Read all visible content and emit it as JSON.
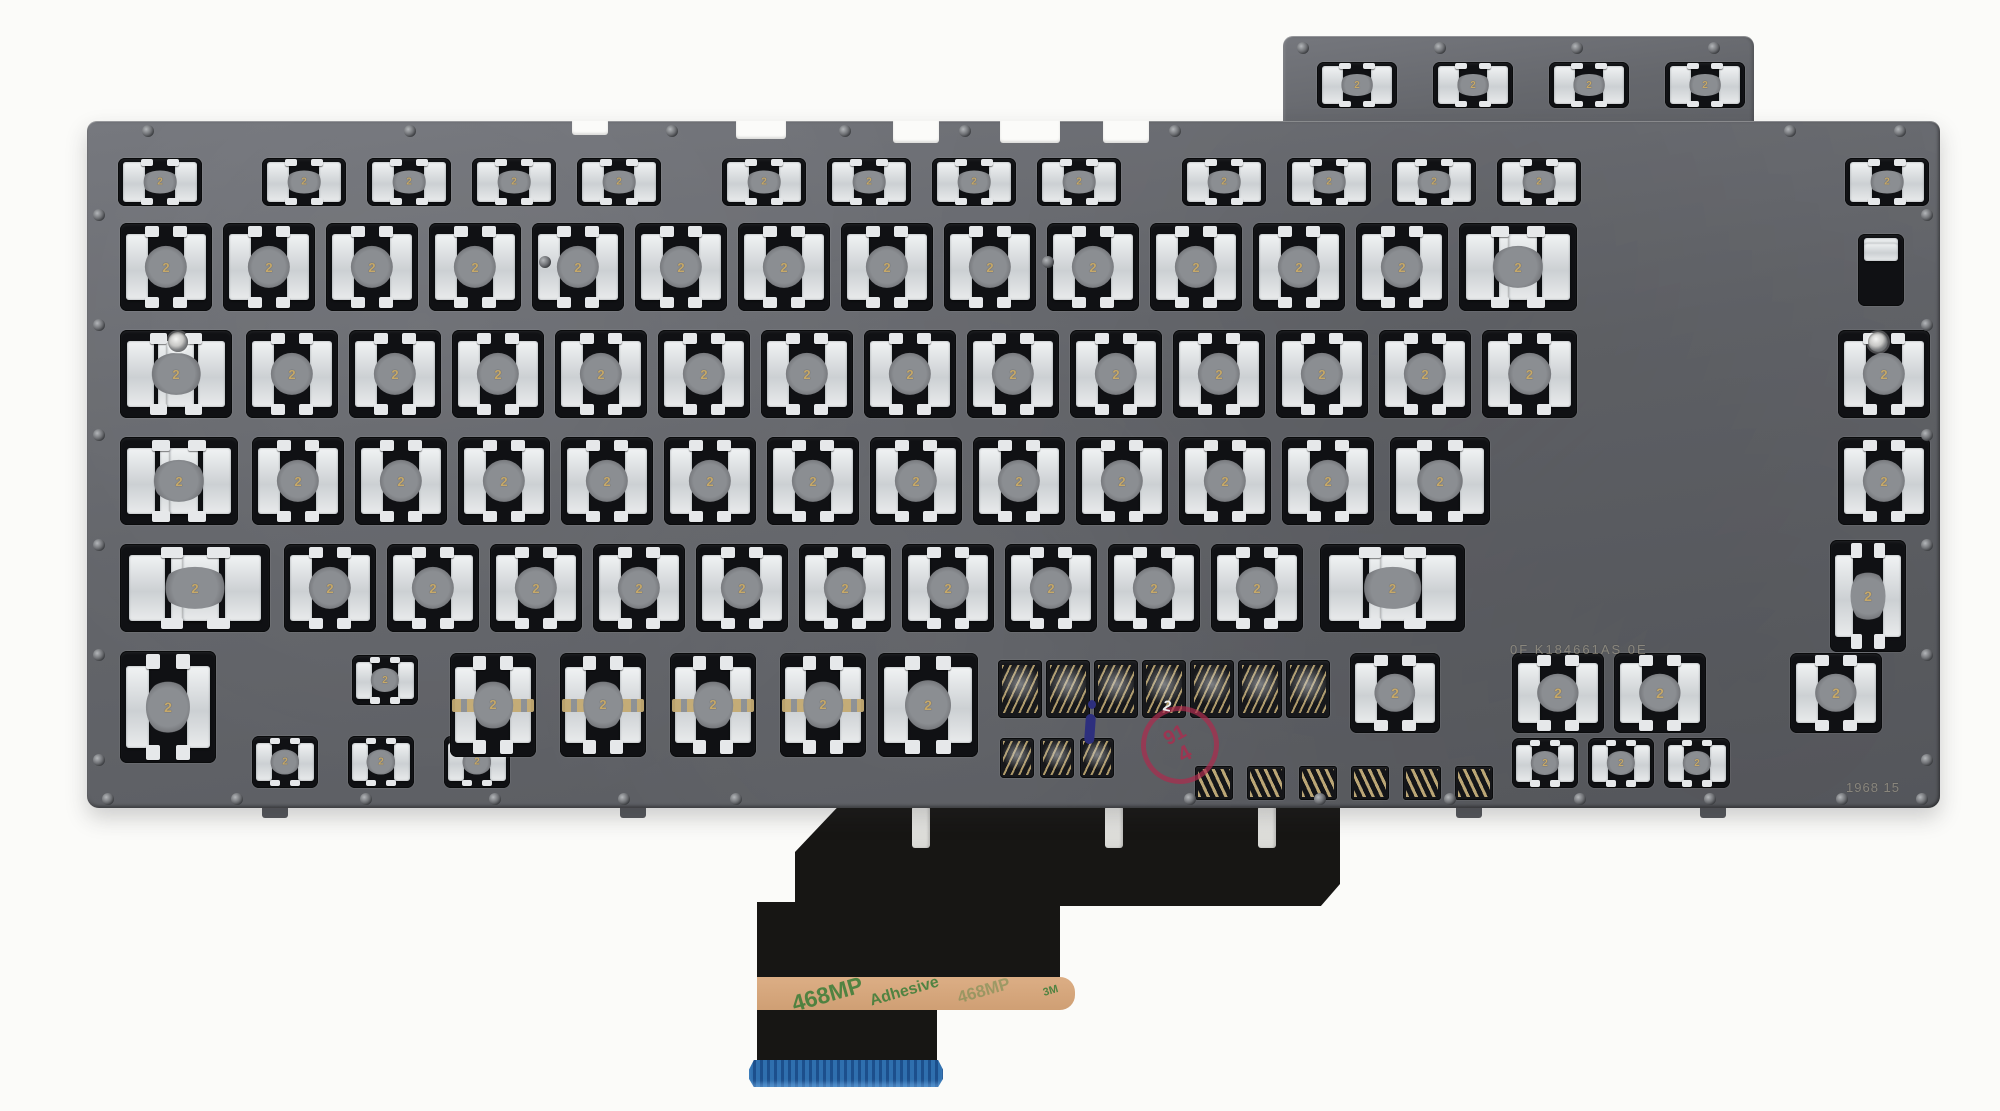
{
  "photo": {
    "markings": {
      "model_id": "0F K184661AS 0E",
      "serial": "1968 15",
      "membrane_glyph": "2",
      "qc_stamp": {
        "line1": "91",
        "line2": "4",
        "color": "#aa2d4e"
      },
      "white_mark": "2",
      "ink_mark_color": "#2d2f7e"
    },
    "ribbon": {
      "adhesive_texts": [
        "468MP",
        "Adhesive",
        "468MP",
        "3M"
      ],
      "adhesive_strip_color": "#d5a77d",
      "cable_color": "#171614",
      "connector_color": "#2f6fae",
      "posts": [
        912,
        1105,
        1258
      ]
    },
    "plate": {
      "color": "#64666b",
      "gold_trace_color": "#c6a868",
      "body": {
        "x": 87,
        "y": 121,
        "w": 1853,
        "h": 687
      },
      "raised_tab": {
        "x": 1283,
        "y": 36,
        "w": 471,
        "h": 90
      },
      "top_notches": [
        {
          "x": 572,
          "w": 36,
          "h": 14
        },
        {
          "x": 736,
          "w": 50,
          "h": 18
        },
        {
          "x": 893,
          "w": 46,
          "h": 22
        },
        {
          "x": 1000,
          "w": 60,
          "h": 22
        },
        {
          "x": 1103,
          "w": 46,
          "h": 22
        }
      ],
      "bottom_tabs": [
        {
          "x": 262,
          "w": 26,
          "h": 12
        },
        {
          "x": 620,
          "w": 26,
          "h": 12
        },
        {
          "x": 1456,
          "w": 26,
          "h": 12
        },
        {
          "x": 1700,
          "w": 26,
          "h": 12
        }
      ],
      "rivets": [
        [
          148,
          131
        ],
        [
          410,
          131
        ],
        [
          672,
          131
        ],
        [
          845,
          131
        ],
        [
          965,
          131
        ],
        [
          1175,
          131
        ],
        [
          1790,
          131
        ],
        [
          1900,
          131
        ],
        [
          1303,
          48
        ],
        [
          1440,
          48
        ],
        [
          1577,
          48
        ],
        [
          1714,
          48
        ],
        [
          99,
          215
        ],
        [
          99,
          325
        ],
        [
          99,
          435
        ],
        [
          99,
          545
        ],
        [
          99,
          655
        ],
        [
          99,
          760
        ],
        [
          1927,
          215
        ],
        [
          1927,
          325
        ],
        [
          1927,
          435
        ],
        [
          1927,
          545
        ],
        [
          1927,
          655
        ],
        [
          1927,
          760
        ],
        [
          108,
          799
        ],
        [
          237,
          799
        ],
        [
          366,
          799
        ],
        [
          495,
          799
        ],
        [
          624,
          799
        ],
        [
          736,
          799
        ],
        [
          1190,
          799
        ],
        [
          1320,
          799
        ],
        [
          1450,
          799
        ],
        [
          1580,
          799
        ],
        [
          1710,
          799
        ],
        [
          1842,
          799
        ],
        [
          1922,
          799
        ],
        [
          545,
          262
        ],
        [
          1048,
          262
        ],
        [
          178,
          342,
          "s"
        ],
        [
          1878,
          342,
          "s"
        ]
      ],
      "switch_groups": [
        {
          "t": "fn",
          "y": 62,
          "h": 46,
          "w": 80,
          "xs": [
            1317,
            1433,
            1549,
            1665
          ]
        },
        {
          "t": "fn",
          "y": 158,
          "h": 48,
          "w": 84,
          "xs": [
            118,
            262,
            367,
            472,
            577,
            722,
            827,
            932,
            1037,
            1182,
            1287,
            1392,
            1497,
            1845
          ]
        },
        {
          "t": "std",
          "y": 223,
          "h": 88,
          "w": 92,
          "xs": [
            120,
            223,
            326,
            429,
            532,
            635,
            738,
            841,
            944,
            1047,
            1150,
            1253,
            1356
          ]
        },
        {
          "t": "wide",
          "y": 223,
          "h": 88,
          "w": 118,
          "dual": 1,
          "xs": [
            1459
          ]
        },
        {
          "t": "vert",
          "y": 234,
          "h": 72,
          "w": 46,
          "xs": [
            1858
          ]
        },
        {
          "t": "wide",
          "y": 330,
          "h": 88,
          "w": 112,
          "dual": 1,
          "xs": [
            120
          ]
        },
        {
          "t": "std",
          "y": 330,
          "h": 88,
          "w": 92,
          "xs": [
            246,
            349,
            452,
            555,
            658,
            761,
            864,
            967,
            1070,
            1173,
            1276,
            1379,
            1838
          ]
        },
        {
          "t": "wide",
          "y": 330,
          "h": 88,
          "w": 95,
          "xs": [
            1482
          ]
        },
        {
          "t": "wide",
          "y": 437,
          "h": 88,
          "w": 118,
          "dual": 1,
          "xs": [
            120
          ]
        },
        {
          "t": "std",
          "y": 437,
          "h": 88,
          "w": 92,
          "xs": [
            252,
            355,
            458,
            561,
            664,
            767,
            870,
            973,
            1076,
            1179,
            1282,
            1838
          ]
        },
        {
          "t": "wide",
          "y": 437,
          "h": 88,
          "w": 100,
          "xs": [
            1390
          ]
        },
        {
          "t": "wide",
          "y": 544,
          "h": 88,
          "w": 150,
          "dual": 1,
          "xs": [
            120
          ]
        },
        {
          "t": "std",
          "y": 544,
          "h": 88,
          "w": 92,
          "xs": [
            284,
            387,
            490,
            593,
            696,
            799,
            902,
            1005,
            1108,
            1211
          ]
        },
        {
          "t": "wide",
          "y": 544,
          "h": 88,
          "w": 145,
          "dual": 1,
          "xs": [
            1320
          ]
        },
        {
          "t": "big",
          "y": 540,
          "h": 112,
          "w": 76,
          "xs": [
            1830
          ]
        },
        {
          "t": "big",
          "y": 651,
          "h": 112,
          "w": 96,
          "xs": [
            120
          ]
        },
        {
          "t": "small",
          "y": 655,
          "h": 50,
          "w": 66,
          "xs": [
            352
          ]
        },
        {
          "t": "small",
          "y": 736,
          "h": 52,
          "w": 66,
          "xs": [
            252,
            348,
            444
          ]
        },
        {
          "t": "space",
          "y": 653,
          "h": 104,
          "w": 86,
          "xs": [
            450,
            560,
            670,
            780
          ]
        },
        {
          "t": "big",
          "y": 653,
          "h": 104,
          "w": 100,
          "xs": [
            878
          ]
        },
        {
          "t": "vent",
          "y": 660,
          "h": 58,
          "w": 44,
          "xs": [
            998,
            1046,
            1094,
            1142,
            1190,
            1238,
            1286
          ]
        },
        {
          "t": "vent",
          "y": 738,
          "h": 40,
          "w": 34,
          "xs": [
            1000,
            1040,
            1080
          ]
        },
        {
          "t": "sym",
          "y": 766,
          "h": 34,
          "w": 38,
          "xs": [
            1195,
            1247,
            1299,
            1351,
            1403,
            1455
          ]
        },
        {
          "t": "big",
          "y": 653,
          "h": 80,
          "w": 90,
          "xs": [
            1350
          ]
        },
        {
          "t": "big",
          "y": 653,
          "h": 80,
          "w": 92,
          "xs": [
            1512,
            1614,
            1790
          ]
        },
        {
          "t": "small",
          "y": 738,
          "h": 50,
          "w": 66,
          "xs": [
            1512,
            1588,
            1664
          ]
        }
      ]
    }
  }
}
